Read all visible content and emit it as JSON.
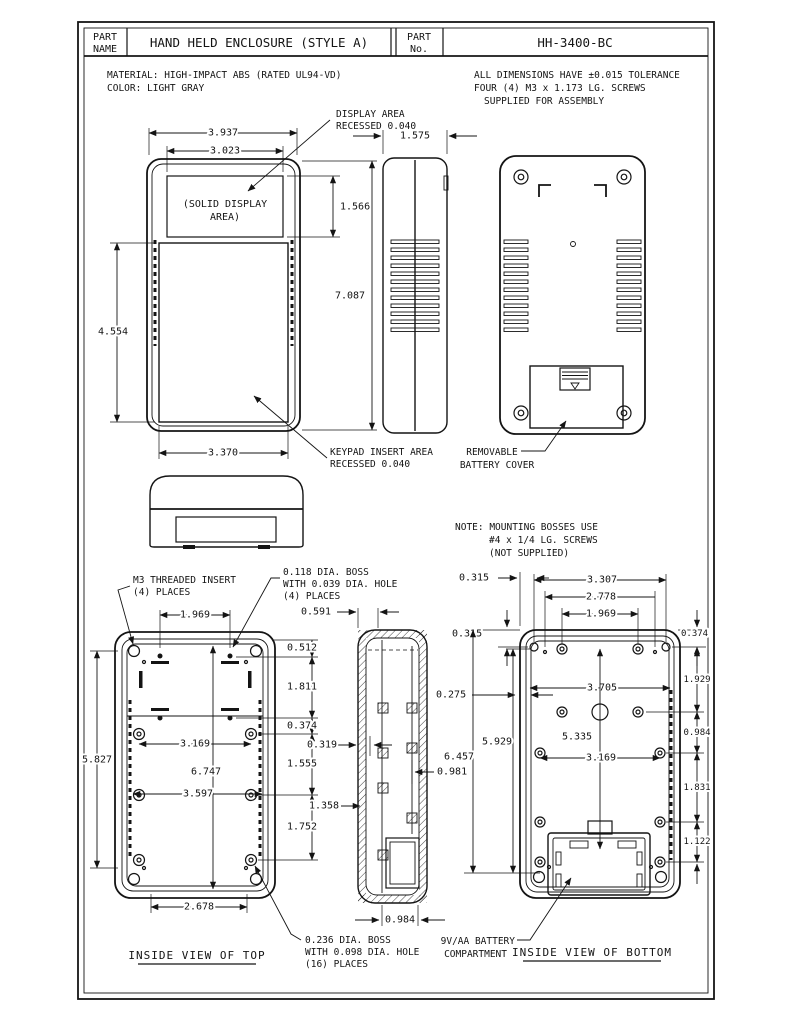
{
  "title_block": {
    "part_name_label_1": "PART",
    "part_name_label_2": "NAME",
    "part_name_value": "HAND HELD ENCLOSURE (STYLE A)",
    "part_no_label_1": "PART",
    "part_no_label_2": "No.",
    "part_no_value": "HH-3400-BC"
  },
  "notes": {
    "material_1": "MATERIAL: HIGH-IMPACT ABS (RATED UL94-VD)",
    "material_2": "COLOR: LIGHT GRAY",
    "tolerance_1": "ALL DIMENSIONS HAVE ±0.015 TOLERANCE",
    "tolerance_2": "FOUR (4) M3 x 1.173 LG. SCREWS",
    "tolerance_3": "SUPPLIED FOR ASSEMBLY",
    "mounting_1": "NOTE: MOUNTING BOSSES USE",
    "mounting_2": "#4 x 1/4 LG. SCREWS",
    "mounting_3": "(NOT SUPPLIED)"
  },
  "front_view": {
    "dim_overall_width": "3.937",
    "dim_display_width": "3.023",
    "dim_display_height": "1.566",
    "dim_overall_height": "7.087",
    "dim_keypad_height": "4.554",
    "dim_keypad_width": "3.370",
    "solid_display_1": "(SOLID DISPLAY",
    "solid_display_2": "AREA)",
    "display_label_1": "DISPLAY AREA",
    "display_label_2": "RECESSED 0.040",
    "keypad_label_1": "KEYPAD INSERT AREA",
    "keypad_label_2": "RECESSED 0.040"
  },
  "side_view": {
    "dim_width": "1.575"
  },
  "back_view": {
    "label_1": "REMOVABLE",
    "label_2": "BATTERY COVER"
  },
  "top_view": {
    "title": "INSIDE VIEW OF TOP",
    "insert_label_1": "M3 THREADED INSERT",
    "insert_label_2": "(4) PLACES",
    "boss4_label_1": "0.118 DIA. BOSS",
    "boss4_label_2": "WITH 0.039 DIA. HOLE",
    "boss4_label_3": "(4) PLACES",
    "boss16_label_1": "0.236 DIA. BOSS",
    "boss16_label_2": "WITH 0.098 DIA. HOLE",
    "boss16_label_3": "(16) PLACES",
    "dim_insert_span": "1.969",
    "dim_left_height": "5.827",
    "dim_top_inset": "0.512",
    "dim_insert_rows": "1.811",
    "dim_row_gap": "0.374",
    "dim_boss_row2": "1.555",
    "dim_boss_row3": "1.752",
    "dim_boss_span": "3.169",
    "dim_inner_height": "6.747",
    "dim_boss_wide_span": "3.597",
    "dim_bottom_span": "2.678"
  },
  "section_view": {
    "dim_top_step": "0.591",
    "dim_wall": "0.319",
    "dim_boss_depth": "1.358",
    "dim_boss_height": "0.981",
    "dim_bottom_width": "0.984"
  },
  "bottom_view": {
    "title": "INSIDE VIEW OF BOTTOM",
    "battery_label_1": "9V/AA BATTERY",
    "battery_label_2": "COMPARTMENT",
    "dim_corner_inset_h": "0.315",
    "dim_corner_inset_v": "0.315",
    "dim_screw_span": "3.307",
    "dim_dot_span": "2.778",
    "dim_insert_span": "1.969",
    "dim_right_inset": "0.374",
    "dim_row1": "1.929",
    "dim_inner_width": "3.705",
    "dim_center_height": "5.335",
    "dim_left_height": "5.929",
    "dim_overall_height": "6.457",
    "dim_wall": "0.275",
    "dim_row2": "0.984",
    "dim_boss_span": "3.169",
    "dim_row3": "1.831",
    "dim_row4": "1.122"
  }
}
